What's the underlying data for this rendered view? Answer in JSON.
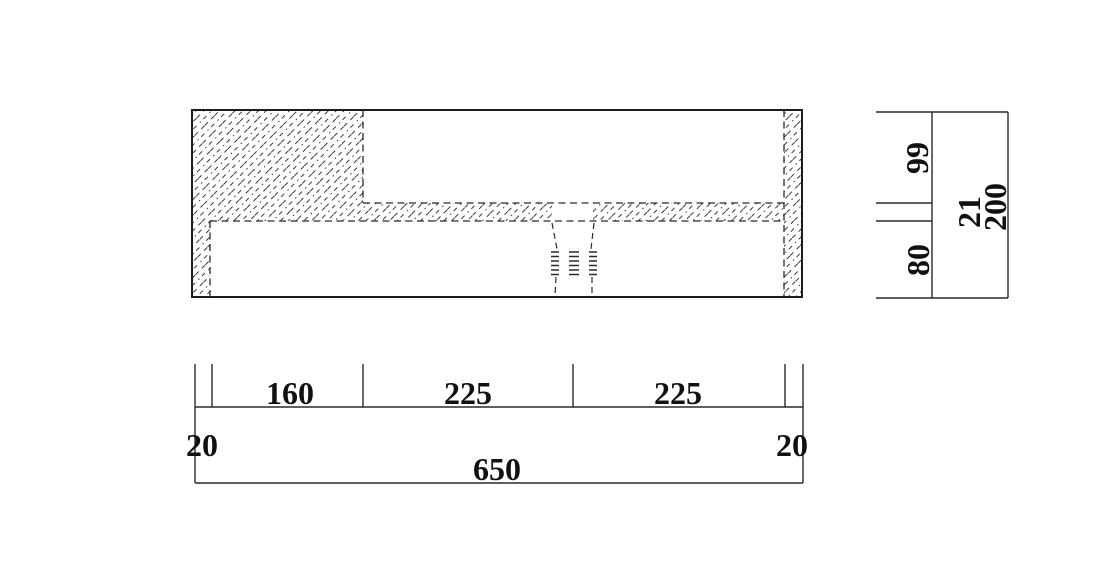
{
  "meta": {
    "description": "CAD cross-section drawing of a basin/counter with drain, hatched walls and dimension chains",
    "colors": {
      "background": "#ffffff",
      "line": "#1c1c1c",
      "text": "#111111"
    }
  },
  "drawing": {
    "bottom_dimension_chain": {
      "segments": [
        "20",
        "160",
        "225",
        "225",
        "20"
      ],
      "overall": "650"
    },
    "right_dimension_chain": {
      "segments": [
        "99",
        "21",
        "80"
      ],
      "overall": "200"
    }
  },
  "labels": {
    "dim_20_left": "20",
    "dim_160": "160",
    "dim_225_left": "225",
    "dim_225_right": "225",
    "dim_20_right": "20",
    "dim_650": "650",
    "dim_99": "99",
    "dim_21": "21",
    "dim_80": "80",
    "dim_200": "200"
  }
}
